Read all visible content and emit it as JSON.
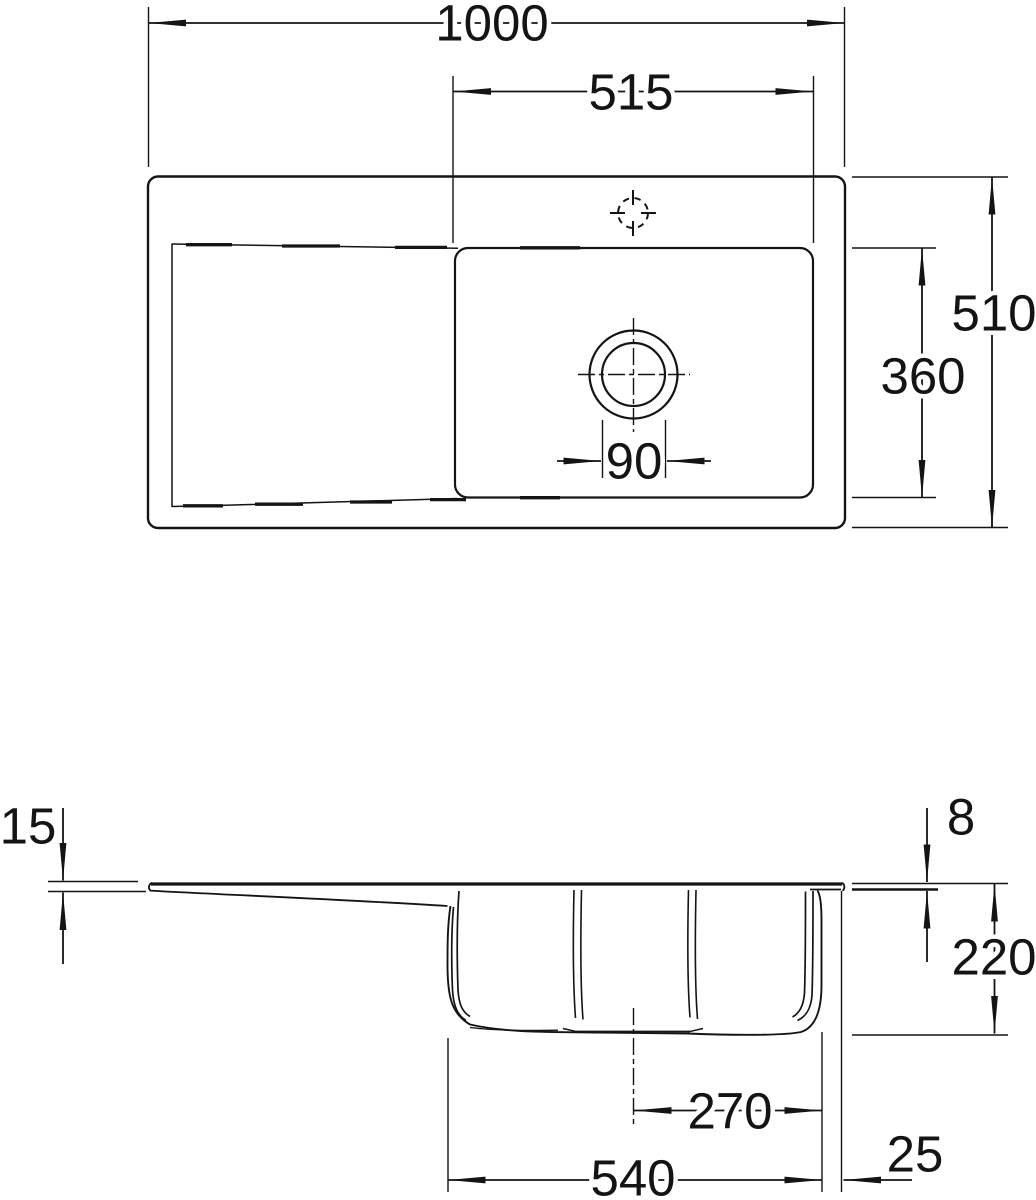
{
  "drawing": {
    "type": "technical-dimension-drawing",
    "subject": "kitchen sink with drainboard, plan view and sectional side view",
    "background_color": "#ffffff",
    "line_color": "#141414",
    "dims": {
      "plan": {
        "overall_width": "1000",
        "bowl_inner_width": "515",
        "overall_depth": "510",
        "bowl_inner_depth": "360",
        "drain_diameter": "90"
      },
      "section": {
        "rim_height_left": "15",
        "rim_thickness_right": "8",
        "bowl_depth": "220",
        "drain_center_to_edge": "270",
        "bowl_outer_width": "540",
        "edge_offset": "25"
      }
    }
  }
}
